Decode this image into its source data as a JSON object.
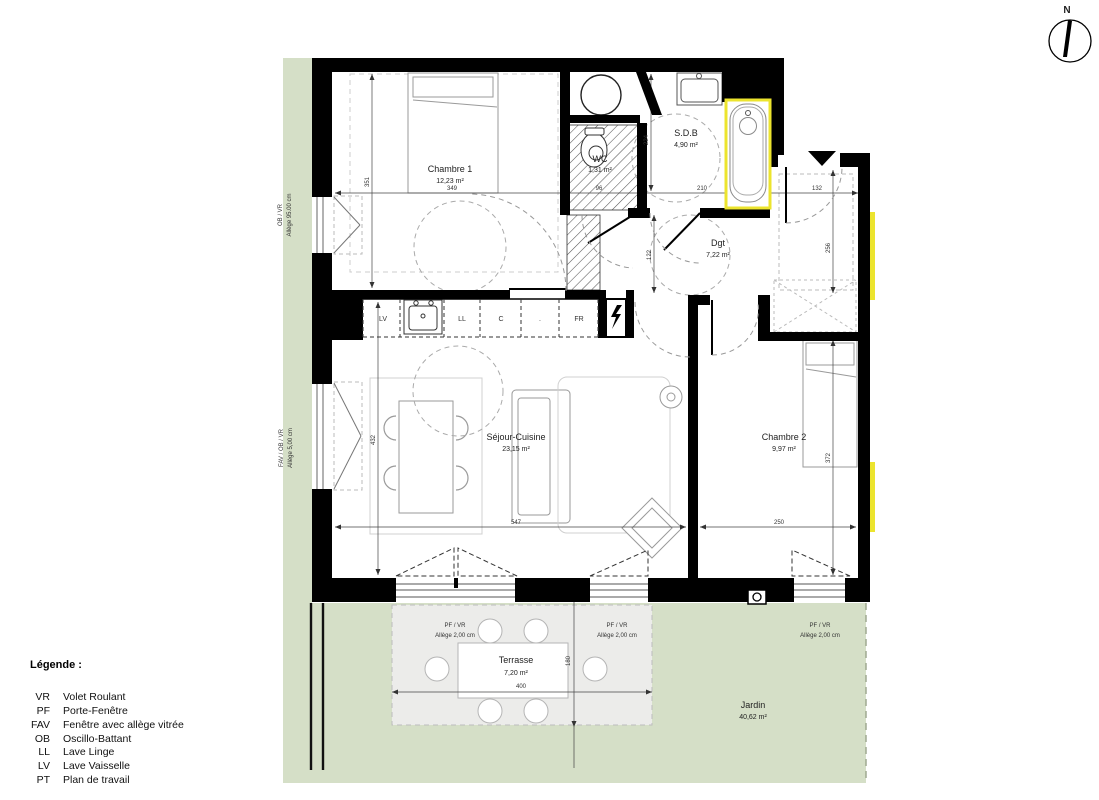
{
  "plan": {
    "compass_north": "N",
    "rooms": {
      "chambre1": {
        "name": "Chambre 1",
        "area": "12,23 m²"
      },
      "wc": {
        "name": "WC",
        "area": "1,31 m²"
      },
      "sdb": {
        "name": "S.D.B",
        "area": "4,90 m²"
      },
      "dgt": {
        "name": "Dgt",
        "area": "7,22 m²"
      },
      "sejour": {
        "name": "Séjour-Cuisine",
        "area": "23,15 m²"
      },
      "chambre2": {
        "name": "Chambre 2",
        "area": "9,97 m²"
      },
      "terrasse": {
        "name": "Terrasse",
        "area": "7,20 m²"
      },
      "jardin": {
        "name": "Jardin",
        "area": "40,62 m²"
      }
    },
    "dims": {
      "chambre1_w": "349",
      "chambre1_h": "351",
      "wc_w": "96",
      "sdb_w": "210",
      "sdb_h": "224",
      "dgt_h": "122",
      "entree_w": "132",
      "entree_h": "256",
      "sejour_w": "547",
      "sejour_h": "432",
      "chambre2_w": "250",
      "chambre2_h": "372",
      "terrasse_w": "400",
      "terrasse_h": "180"
    },
    "kitchen_units": {
      "lv": "LV",
      "ll": "LL",
      "c": "C",
      "dot": ".",
      "fr": "FR"
    },
    "window_labels": {
      "left_top_1": "OB / VR",
      "left_top_2": "Allège  95.00 cm",
      "left_bottom_1": "FAV / OB / VR",
      "left_bottom_2": "Allège  5,00 cm",
      "terrace_left_1": "PF / VR",
      "terrace_left_2": "Allège  2,00 cm",
      "terrace_mid_1": "PF / VR",
      "terrace_mid_2": "Allège  2,00 cm",
      "garden_1": "PF / VR",
      "garden_2": "Allège  2,00 cm"
    }
  },
  "legend": {
    "title": "Légende :",
    "items": [
      {
        "abbr": "VR",
        "label": "Volet Roulant"
      },
      {
        "abbr": "PF",
        "label": "Porte-Fenêtre"
      },
      {
        "abbr": "FAV",
        "label": "Fenêtre avec allège vitrée"
      },
      {
        "abbr": "OB",
        "label": "Oscillo-Battant"
      },
      {
        "abbr": "LL",
        "label": "Lave Linge"
      },
      {
        "abbr": "LV",
        "label": "Lave Vaisselle"
      },
      {
        "abbr": "PT",
        "label": "Plan de travail"
      }
    ]
  },
  "colors": {
    "garden": "#d5dfc7",
    "terrace": "#ececea",
    "wall": "#000000",
    "highlight_yellow": "#ece42e"
  }
}
